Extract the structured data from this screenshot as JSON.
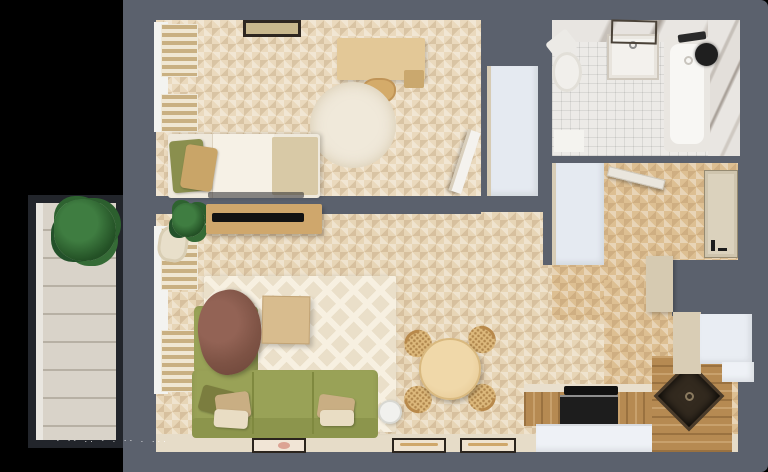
{
  "image": {
    "description": "Top-down 3D rendered floor plan of a one-bedroom apartment with balcony",
    "watermark_text": "- -- .. - . -- . ..."
  },
  "palette": {
    "background": "#000000",
    "wall_gray": "#5b616d",
    "floor_light_wood": "#e7d5b6",
    "floor_warm_wood": "#ddbf92",
    "rustic_counter_wood": "#b68a52",
    "sofa_green": "#99a257",
    "blanket_brown": "#7e5345",
    "white_furniture": "#e5eaf1",
    "beige_unit": "#d7cbb2",
    "bath_tile": "#eceae7",
    "marble": "#e3dfda",
    "plant_green": "#2c5f2e",
    "appliance_black": "#161616"
  },
  "rooms": [
    {
      "name": "Bedroom",
      "furniture": [
        "bed",
        "green-pillow",
        "tan-pillow",
        "duvet",
        "beige-throw",
        "desk",
        "desk-chair",
        "round-rug",
        "window-blinds",
        "wall-picture",
        "open-door",
        "wardrobe"
      ]
    },
    {
      "name": "Bathroom",
      "furniture": [
        "bathtub",
        "shower-head",
        "vanity-sink",
        "mirror",
        "toilet",
        "bath-mat",
        "marble-wall"
      ]
    },
    {
      "name": "Hallway",
      "furniture": [
        "entry-door",
        "bathroom-door",
        "closet",
        "tall-cabinet"
      ]
    },
    {
      "name": "Living Room",
      "furniture": [
        "corner-sofa",
        "throw-blanket",
        "cushions",
        "coffee-table",
        "area-rug",
        "tv-stand",
        "tv",
        "armchair",
        "potted-plant",
        "floor-lamp",
        "window-blinds",
        "small-mat"
      ]
    },
    {
      "name": "Kitchen-Dining",
      "furniture": [
        "round-dining-table",
        "dining-chair-1",
        "dining-chair-2",
        "dining-chair-3",
        "dining-chair-4",
        "counter-with-cooktop",
        "oven",
        "corner-sink",
        "fridge",
        "upper-cabinets",
        "framed-mats"
      ]
    },
    {
      "name": "Balcony",
      "furniture": [
        "potted-plant",
        "plank-floor",
        "railing-frame"
      ]
    }
  ]
}
